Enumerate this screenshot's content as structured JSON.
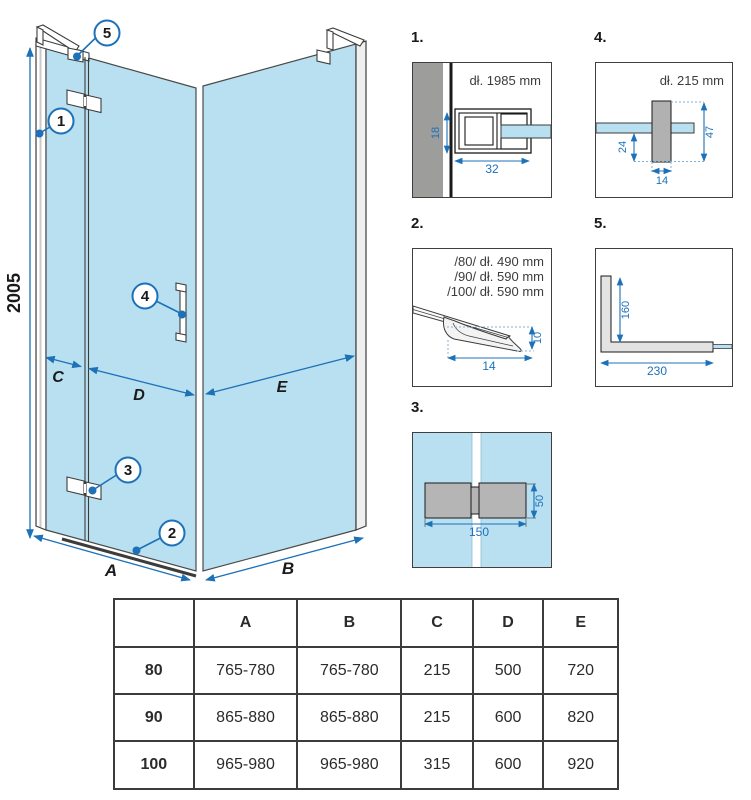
{
  "colors": {
    "glass": "#b9e0f0",
    "dimension_blue": "#1d71b8",
    "wall_gray": "#9d9d9c",
    "hardware_gray": "#b5b5b5",
    "outline": "#3c3c3b"
  },
  "main": {
    "height_dim": "2005",
    "dims": {
      "a": "A",
      "b": "B",
      "c": "C",
      "d": "D",
      "e": "E"
    },
    "callouts": {
      "c1": "1",
      "c2": "2",
      "c3": "3",
      "c4": "4",
      "c5": "5"
    }
  },
  "details": {
    "d1": {
      "title": "1.",
      "length": "dł. 1985 mm",
      "dim_depth": "18",
      "dim_width": "32"
    },
    "d2": {
      "title": "2.",
      "lines": [
        "/80/ dł. 490 mm",
        "/90/ dł. 590 mm",
        "/100/ dł. 590 mm"
      ],
      "dim_height": "10",
      "dim_width": "14"
    },
    "d3": {
      "title": "3.",
      "dim_height": "50",
      "dim_width": "150"
    },
    "d4": {
      "title": "4.",
      "length": "dł. 215 mm",
      "dim_offset": "24",
      "dim_height": "47",
      "dim_width": "14"
    },
    "d5": {
      "title": "5.",
      "dim_height": "160",
      "dim_width": "230"
    }
  },
  "table": {
    "headers": [
      "",
      "A",
      "B",
      "C",
      "D",
      "E"
    ],
    "rows": [
      {
        "label": "80",
        "values": [
          "765-780",
          "765-780",
          "215",
          "500",
          "720"
        ]
      },
      {
        "label": "90",
        "values": [
          "865-880",
          "865-880",
          "215",
          "600",
          "820"
        ]
      },
      {
        "label": "100",
        "values": [
          "965-980",
          "965-980",
          "315",
          "600",
          "920"
        ]
      }
    ]
  }
}
